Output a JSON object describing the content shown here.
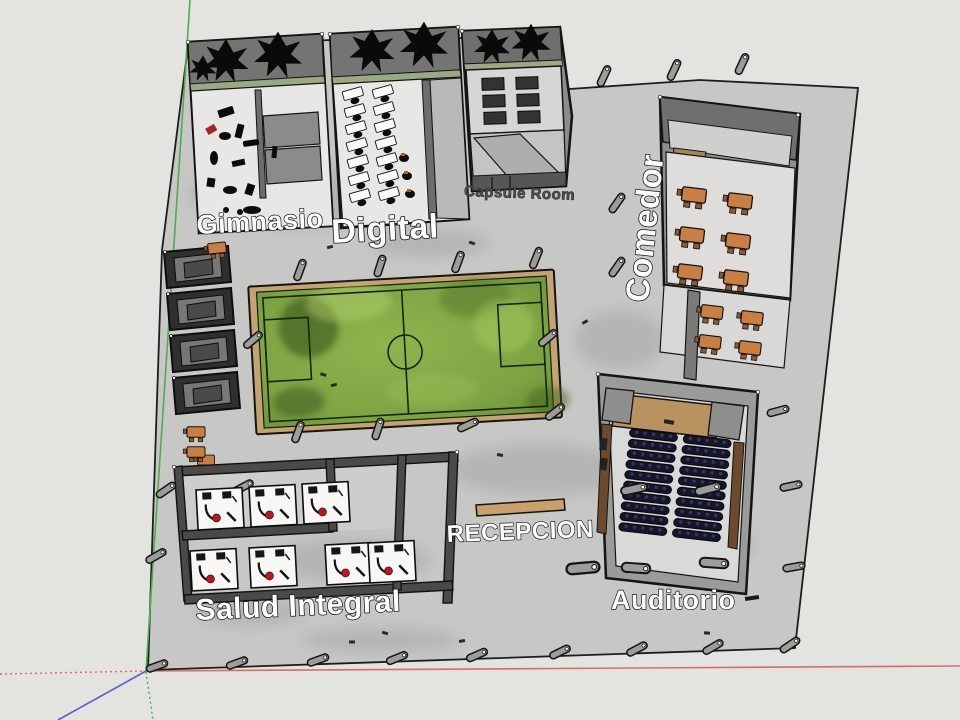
{
  "labels": {
    "gimnasio": "Gimnasio",
    "digital": "Digital",
    "capsule_room": "Capsule Room",
    "comedor": "Comedor",
    "recepcion": "RECEPCION",
    "salud_integral": "Salud Integral",
    "auditorio": "Auditorio"
  },
  "counts": {
    "digital_desk_rows": 7,
    "auditorio_seat_rows": 10,
    "auditorio_seat_columns": 2,
    "comedor_tables_inside": 6,
    "comedor_tables_terrace": 4,
    "salud_stations_top_row": 3,
    "salud_stations_bottom_row": 4,
    "storage_cubbies": 4
  },
  "colors": {
    "background": "#e3e3e0",
    "floor_slab": "#c7c7c5",
    "wall_gray": "#8c8c8a",
    "wall_dark": "#747472",
    "interior_floor": "#e7e7e5",
    "outline": "#141414",
    "field_green": "#84aa46",
    "field_green_dark": "#33511a",
    "field_frame_tan": "#c5a271",
    "field_line": "#15260a",
    "table_orange": "#c97f42",
    "stool_brown": "#8a5a30",
    "stage_tan": "#b9935f",
    "wood_brown": "#6b4a2e",
    "seat_dark": "#16162a",
    "bed_white": "#f7f7f5",
    "accent_red": "#c41220",
    "plant_black": "#0a0a0a",
    "axis_green": "#4cae4c",
    "axis_red": "#d96b6b",
    "axis_blue": "#5c5cd6"
  }
}
